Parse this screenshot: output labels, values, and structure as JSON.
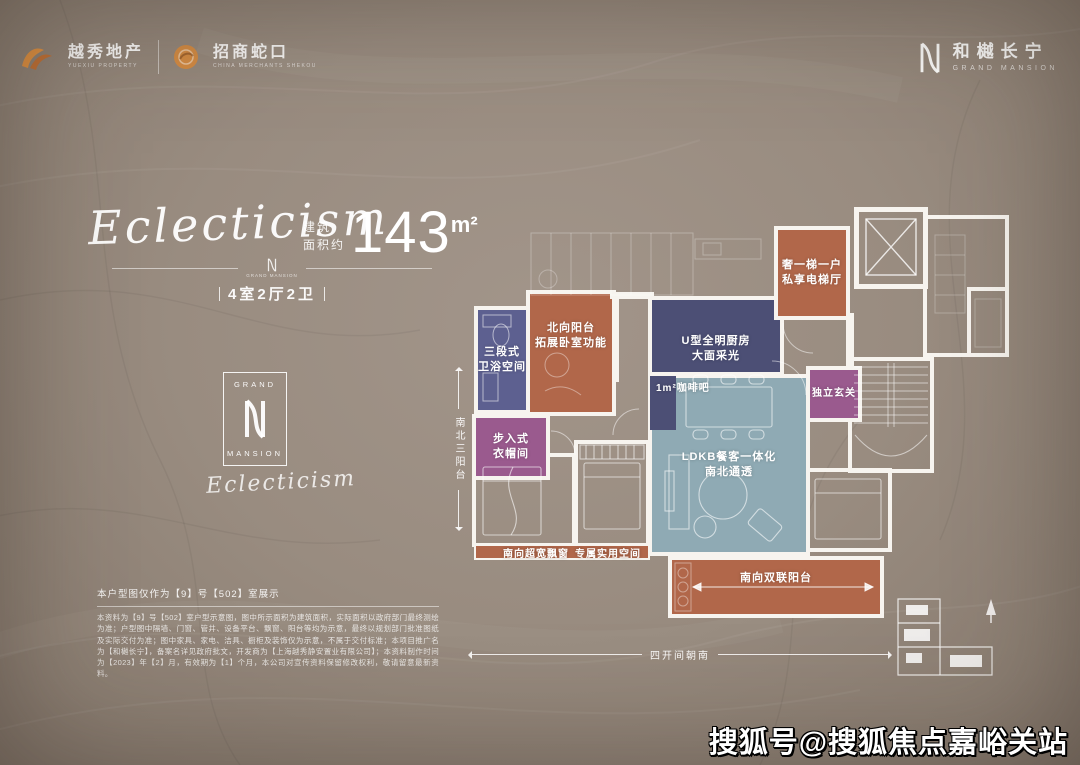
{
  "page": {
    "watermark": "搜狐号@搜狐焦点嘉峪关站",
    "bg_color": "#998c80"
  },
  "header": {
    "yuexiu": {
      "name": "越秀地产",
      "sub": "YUEXIU PROPERTY"
    },
    "zhaoshang": {
      "name": "招商蛇口",
      "sub": "CHINA MERCHANTS SHEKOU"
    },
    "brand": {
      "name": "和樾长宁",
      "sub": "GRAND MANSION"
    }
  },
  "hero": {
    "script": "Eclecticism",
    "area_prefix": "建筑\n面积约",
    "area_value": "143",
    "area_unit": "m²",
    "spec": "4室2厅2卫"
  },
  "emblem": {
    "top": "GRAND",
    "bottom": "MANSION",
    "small_caption": "GRAND MANSION",
    "script": "Eclecticism"
  },
  "plan": {
    "labels": {
      "north_balcony": "北向阳台\n拓展卧室功能",
      "bathroom": "三段式\n卫浴空间",
      "closet": "步入式\n衣帽间",
      "kitchen": "U型全明厨房\n大面采光",
      "coffee": "1m²咖啡吧",
      "ldk": "LDKB餐客一体化\n南北通透",
      "foyer": "独立玄关",
      "elevator_hall": "奢一梯一户\n私享电梯厅",
      "bay_window": "南向超宽飘窗",
      "utility": "专属实用空间",
      "south_balcony": "南向双联阳台"
    },
    "dims": {
      "vertical": "南北三阳台",
      "horizontal": "四开间朝南"
    }
  },
  "footer": {
    "note": "本户型图仅作为【9】号【502】室展示",
    "disclaimer": "本资料为【9】号【502】室户型示意图，图中所示面积为建筑面积，实际面积以政府部门最终测绘为准；户型图中隔墙、门窗、管井、设备平台、飘窗、阳台等均为示意，最终以规划部门批准图纸及实际交付为准；图中家具、家电、洁具、橱柜及装饰仅为示意，不属于交付标准；本项目推广名为【和樾长宁】，备案名详见政府批文，开发商为【上海越秀静安置业有限公司】；本资料制作时间为【2023】年【2】月，有效期为【1】个月，本公司对宣传资料保留修改权利，敬请留意最新资料。"
  },
  "colors": {
    "accent_orange": "#d98a3f",
    "room_orange": "#b1674a",
    "room_navy": "#4c4f75",
    "room_purple": "#5d6090",
    "room_magenta": "#9a5a8e",
    "room_teal": "#8faab4",
    "wall_white": "#f7f4ef"
  }
}
